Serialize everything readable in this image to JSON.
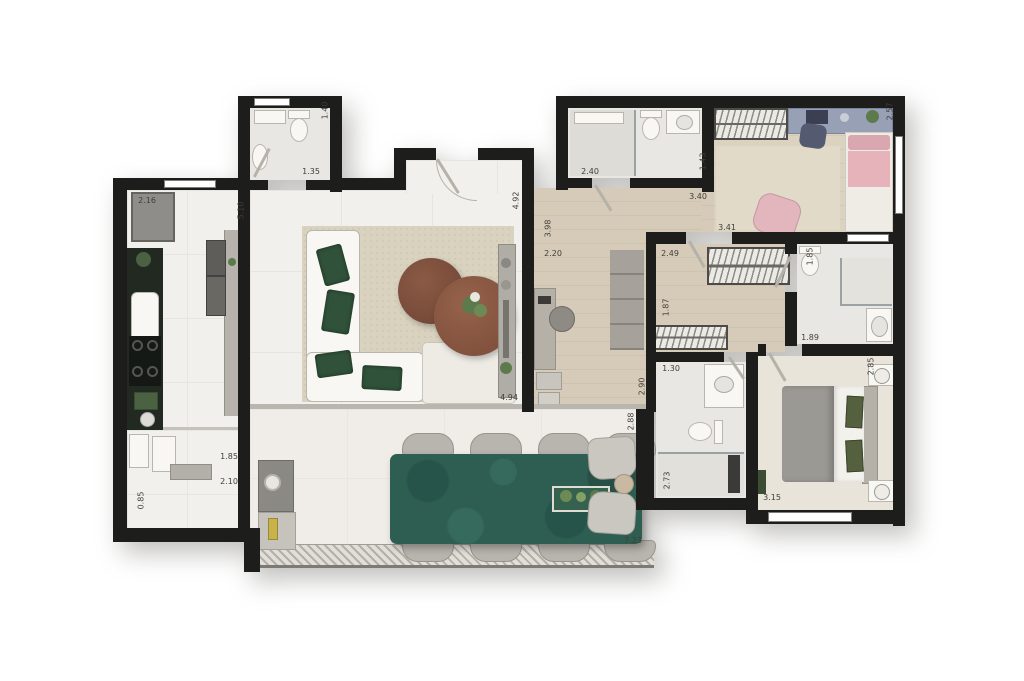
{
  "document": {
    "type": "apartment-floor-plan",
    "units": "meters"
  },
  "palette": {
    "wall": "#1d1d1b",
    "tile_floor": "#f2f0ec",
    "wood_floor": "#d5cab7",
    "bath_floor": "#e9e7e3",
    "terrace_floor": "#f0ede8",
    "kitchen_counter": "#222a22",
    "dining_table_green": "#2e5e52",
    "sofa_pillow_green": "#31523a",
    "pink_furniture": "#e5b0b8",
    "desk_blue": "#98a0b5",
    "rug_beige": "#d9d2bf",
    "dimension_text": "#403e3a"
  },
  "dimensions": [
    {
      "text": "1.35",
      "x": 298,
      "y": 167,
      "rot": 0
    },
    {
      "text": "1.40",
      "x": 312,
      "y": 106,
      "rot": 90
    },
    {
      "text": "2.16",
      "x": 134,
      "y": 196,
      "rot": 0
    },
    {
      "text": "5.10",
      "x": 228,
      "y": 206,
      "rot": 90
    },
    {
      "text": "1.85",
      "x": 216,
      "y": 452,
      "rot": 0
    },
    {
      "text": "2.10",
      "x": 216,
      "y": 477,
      "rot": 0
    },
    {
      "text": "0.85",
      "x": 128,
      "y": 496,
      "rot": 90
    },
    {
      "text": "4.92",
      "x": 503,
      "y": 196,
      "rot": 90
    },
    {
      "text": "3.98",
      "x": 535,
      "y": 224,
      "rot": 90
    },
    {
      "text": "4.94",
      "x": 496,
      "y": 393,
      "rot": 0
    },
    {
      "text": "2.20",
      "x": 540,
      "y": 249,
      "rot": 0
    },
    {
      "text": "2.90",
      "x": 629,
      "y": 382,
      "rot": 90
    },
    {
      "text": "2.40",
      "x": 577,
      "y": 167,
      "rot": 0
    },
    {
      "text": "1.43",
      "x": 690,
      "y": 157,
      "rot": 90
    },
    {
      "text": "3.40",
      "x": 685,
      "y": 192,
      "rot": 0
    },
    {
      "text": "3.41",
      "x": 714,
      "y": 223,
      "rot": 0
    },
    {
      "text": "2.57",
      "x": 877,
      "y": 107,
      "rot": 90
    },
    {
      "text": "2.49",
      "x": 657,
      "y": 249,
      "rot": 0
    },
    {
      "text": "1.87",
      "x": 653,
      "y": 303,
      "rot": 90
    },
    {
      "text": "1.85",
      "x": 797,
      "y": 252,
      "rot": 90
    },
    {
      "text": "1.89",
      "x": 797,
      "y": 333,
      "rot": 0
    },
    {
      "text": "1.30",
      "x": 658,
      "y": 364,
      "rot": 0
    },
    {
      "text": "2.73",
      "x": 654,
      "y": 476,
      "rot": 90
    },
    {
      "text": "3.15",
      "x": 759,
      "y": 493,
      "rot": 0
    },
    {
      "text": "2.85",
      "x": 858,
      "y": 362,
      "rot": 90
    },
    {
      "text": "2.88",
      "x": 618,
      "y": 417,
      "rot": 90
    },
    {
      "text": "7.23",
      "x": 620,
      "y": 536,
      "rot": 0
    }
  ]
}
